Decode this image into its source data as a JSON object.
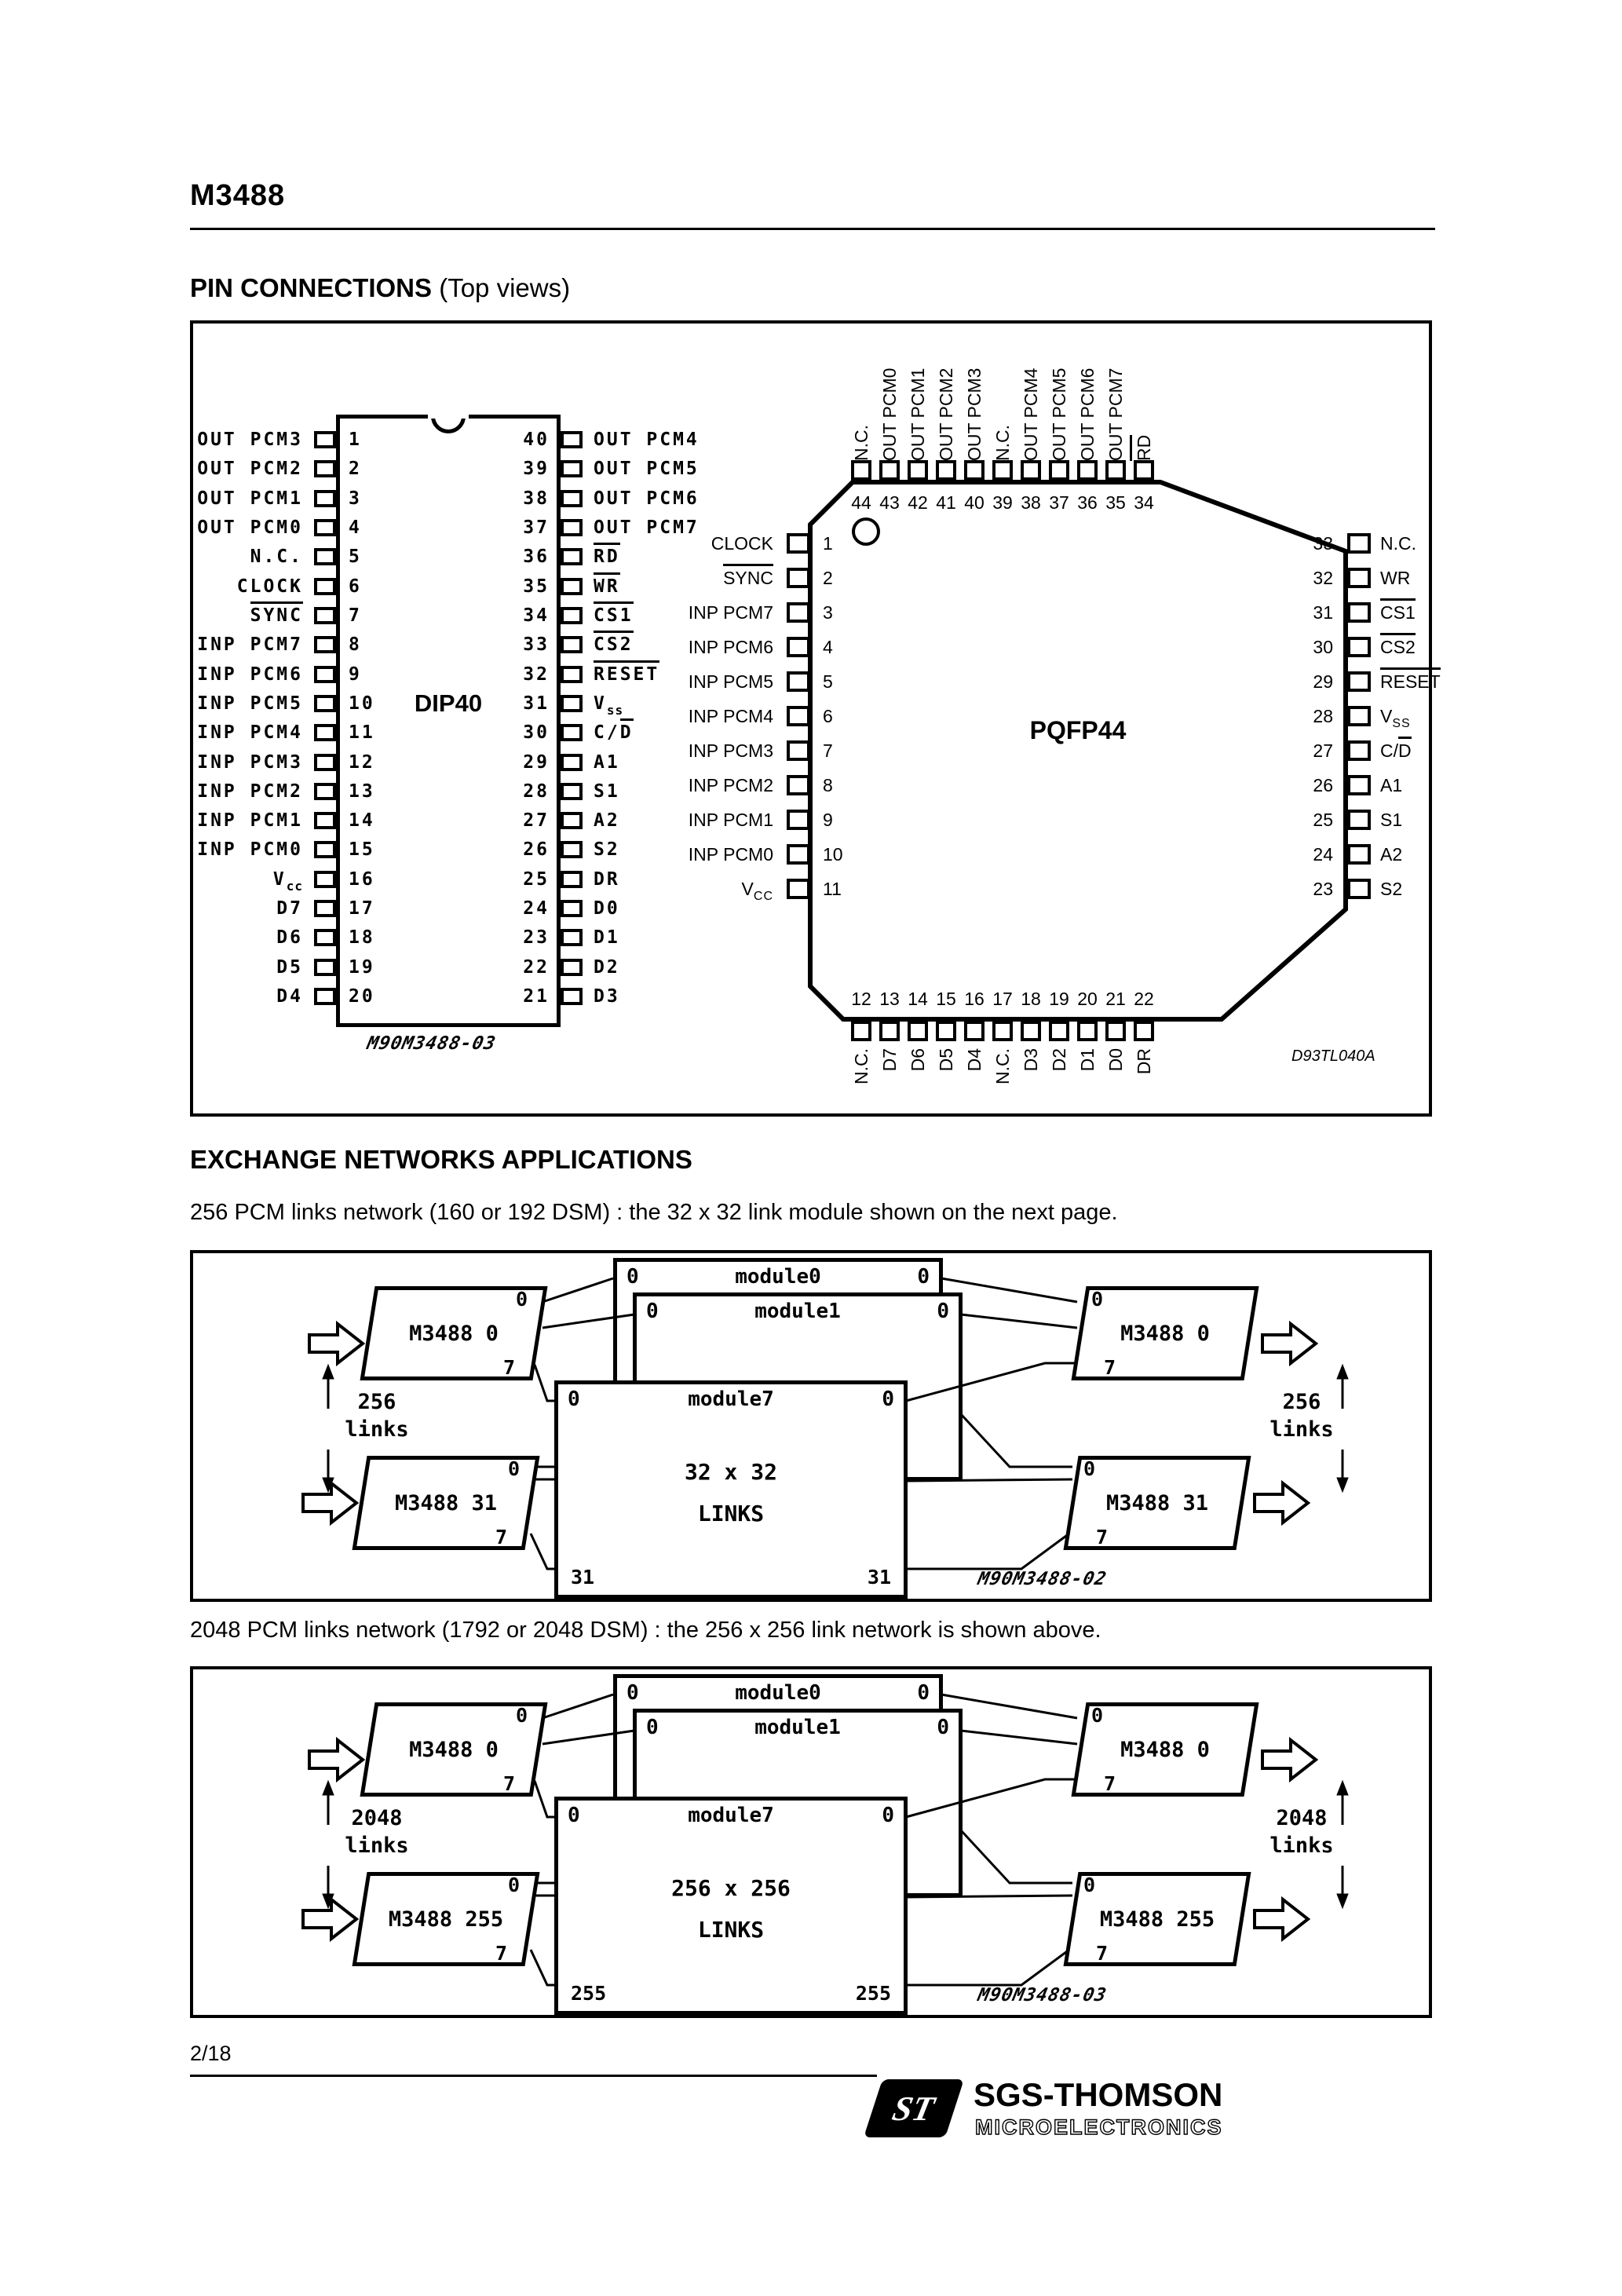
{
  "header": {
    "title": "M3488"
  },
  "sections": {
    "pin_connections": "PIN CONNECTIONS",
    "pin_connections_suffix": " (Top views)",
    "exchange": "EXCHANGE NETWORKS APPLICATIONS"
  },
  "paragraphs": {
    "p1": "256 PCM links network (160 or 192 DSM) : the 32 x 32 link module shown on the next page.",
    "p2": "2048 PCM links network (1792 or 2048 DSM) : the 256 x 256 link network is shown above."
  },
  "dip40": {
    "package": "DIP40",
    "code": "M90M3488-03",
    "left_pins": [
      {
        "n": "1",
        "pre": "OUT PCM3"
      },
      {
        "n": "2",
        "pre": "OUT PCM2"
      },
      {
        "n": "3",
        "pre": "OUT PCM1"
      },
      {
        "n": "4",
        "pre": "OUT PCM0"
      },
      {
        "n": "5",
        "pre": "N.C."
      },
      {
        "n": "6",
        "pre": "CLOCK"
      },
      {
        "n": "7",
        "ov": "SYNC"
      },
      {
        "n": "8",
        "pre": "INP PCM7"
      },
      {
        "n": "9",
        "pre": "INP PCM6"
      },
      {
        "n": "10",
        "pre": "INP PCM5"
      },
      {
        "n": "11",
        "pre": "INP PCM4"
      },
      {
        "n": "12",
        "pre": "INP PCM3"
      },
      {
        "n": "13",
        "pre": "INP PCM2"
      },
      {
        "n": "14",
        "pre": "INP PCM1"
      },
      {
        "n": "15",
        "pre": "INP PCM0"
      },
      {
        "n": "16",
        "pre": "V",
        "sub": "cc"
      },
      {
        "n": "17",
        "pre": "D7"
      },
      {
        "n": "18",
        "pre": "D6"
      },
      {
        "n": "19",
        "pre": "D5"
      },
      {
        "n": "20",
        "pre": "D4"
      }
    ],
    "right_pins": [
      {
        "n": "40",
        "pre": "OUT PCM4"
      },
      {
        "n": "39",
        "pre": "OUT PCM5"
      },
      {
        "n": "38",
        "pre": "OUT PCM6"
      },
      {
        "n": "37",
        "pre": "OUT PCM7"
      },
      {
        "n": "36",
        "ov": "RD"
      },
      {
        "n": "35",
        "ov": "WR"
      },
      {
        "n": "34",
        "ov": "CS1"
      },
      {
        "n": "33",
        "ov": "CS2"
      },
      {
        "n": "32",
        "ov": "RESET"
      },
      {
        "n": "31",
        "pre": "V",
        "sub": "ss"
      },
      {
        "n": "30",
        "pre": "C/",
        "ov": "D"
      },
      {
        "n": "29",
        "pre": "A1"
      },
      {
        "n": "28",
        "pre": "S1"
      },
      {
        "n": "27",
        "pre": "A2"
      },
      {
        "n": "26",
        "pre": "S2"
      },
      {
        "n": "25",
        "pre": "DR"
      },
      {
        "n": "24",
        "pre": "D0"
      },
      {
        "n": "23",
        "pre": "D1"
      },
      {
        "n": "22",
        "pre": "D2"
      },
      {
        "n": "21",
        "pre": "D3"
      }
    ]
  },
  "pqfp44": {
    "package": "PQFP44",
    "ref": "D93TL040A",
    "top_pins": [
      {
        "n": "44",
        "pre": "N.C."
      },
      {
        "n": "43",
        "pre": "OUT PCM0"
      },
      {
        "n": "42",
        "pre": "OUT PCM1"
      },
      {
        "n": "41",
        "pre": "OUT PCM2"
      },
      {
        "n": "40",
        "pre": "OUT PCM3"
      },
      {
        "n": "39",
        "pre": "N.C."
      },
      {
        "n": "38",
        "pre": "OUT PCM4"
      },
      {
        "n": "37",
        "pre": "OUT PCM5"
      },
      {
        "n": "36",
        "pre": "OUT PCM6"
      },
      {
        "n": "35",
        "pre": "OUT PCM7"
      },
      {
        "n": "34",
        "ov": "RD"
      }
    ],
    "left_pins": [
      {
        "n": "1",
        "pre": "CLOCK"
      },
      {
        "n": "2",
        "ov": "SYNC"
      },
      {
        "n": "3",
        "pre": "INP PCM7"
      },
      {
        "n": "4",
        "pre": "INP PCM6"
      },
      {
        "n": "5",
        "pre": "INP PCM5"
      },
      {
        "n": "6",
        "pre": "INP PCM4"
      },
      {
        "n": "7",
        "pre": "INP PCM3"
      },
      {
        "n": "8",
        "pre": "INP PCM2"
      },
      {
        "n": "9",
        "pre": "INP PCM1"
      },
      {
        "n": "10",
        "pre": "INP PCM0"
      },
      {
        "n": "11",
        "pre": "V",
        "sub": "CC"
      }
    ],
    "right_pins": [
      {
        "n": "33",
        "pre": "N.C."
      },
      {
        "n": "32",
        "pre": "WR"
      },
      {
        "n": "31",
        "ov": "CS1"
      },
      {
        "n": "30",
        "ov": "CS2"
      },
      {
        "n": "29",
        "ov": "RESET"
      },
      {
        "n": "28",
        "pre": "V",
        "sub": "SS"
      },
      {
        "n": "27",
        "pre": "C/",
        "ov": "D"
      },
      {
        "n": "26",
        "pre": "A1"
      },
      {
        "n": "25",
        "pre": "S1"
      },
      {
        "n": "24",
        "pre": "A2"
      },
      {
        "n": "23",
        "pre": "S2"
      }
    ],
    "bottom_pins": [
      {
        "n": "12",
        "pre": "N.C."
      },
      {
        "n": "13",
        "pre": "D7"
      },
      {
        "n": "14",
        "pre": "D6"
      },
      {
        "n": "15",
        "pre": "D5"
      },
      {
        "n": "16",
        "pre": "D4"
      },
      {
        "n": "17",
        "pre": "N.C."
      },
      {
        "n": "18",
        "pre": "D3"
      },
      {
        "n": "19",
        "pre": "D2"
      },
      {
        "n": "20",
        "pre": "D1"
      },
      {
        "n": "21",
        "pre": "D0"
      },
      {
        "n": "22",
        "pre": "DR"
      }
    ]
  },
  "network_256": {
    "links_count": "256",
    "links_word": "links",
    "chip_top": "M3488 0",
    "chip_bottom": "M3488 31",
    "port_top": "0",
    "port_bottom": "7",
    "modules": {
      "m0": "module0",
      "m1": "module1",
      "m7": "module7"
    },
    "module_port": "0",
    "matrix_line1": "32 x 32",
    "matrix_line2": "LINKS",
    "matrix_corner_left": "31",
    "matrix_corner_right": "31",
    "code": "M90M3488-02"
  },
  "network_2048": {
    "links_count": "2048",
    "links_word": "links",
    "chip_top": "M3488 0",
    "chip_bottom": "M3488 255",
    "port_top": "0",
    "port_bottom": "7",
    "modules": {
      "m0": "module0",
      "m1": "module1",
      "m7": "module7"
    },
    "module_port": "0",
    "matrix_line1": "256 x 256",
    "matrix_line2": "LINKS",
    "matrix_corner_left": "255",
    "matrix_corner_right": "255",
    "code": "M90M3488-03"
  },
  "footer": {
    "page_number": "2/18",
    "brand": "SGS-THOMSON",
    "brand_sub": "MICROELECTRONICS",
    "logo_text": "ST"
  },
  "colors": {
    "ink": "#000000",
    "paper": "#ffffff"
  }
}
